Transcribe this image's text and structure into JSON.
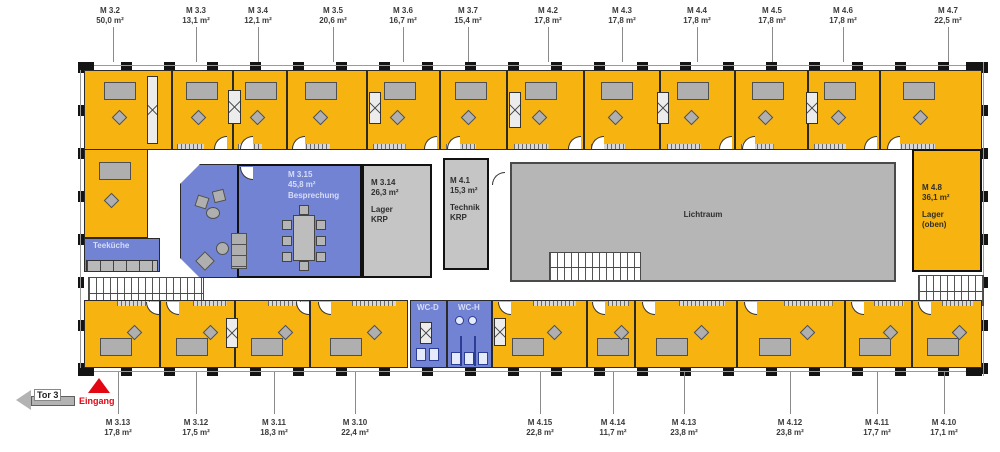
{
  "rooms": {
    "m3_2": {
      "label": "M 3.2",
      "area": "50,0 m²"
    },
    "m3_3": {
      "label": "M 3.3",
      "area": "13,1 m²"
    },
    "m3_4": {
      "label": "M 3.4",
      "area": "12,1 m²"
    },
    "m3_5": {
      "label": "M 3.5",
      "area": "20,6 m²"
    },
    "m3_6": {
      "label": "M 3.6",
      "area": "16,7 m²"
    },
    "m3_7": {
      "label": "M 3.7",
      "area": "15,4 m²"
    },
    "m4_2": {
      "label": "M 4.2",
      "area": "17,8 m²"
    },
    "m4_3": {
      "label": "M 4.3",
      "area": "17,8 m²"
    },
    "m4_4": {
      "label": "M 4.4",
      "area": "17,8 m²"
    },
    "m4_5": {
      "label": "M 4.5",
      "area": "17,8 m²"
    },
    "m4_6": {
      "label": "M 4.6",
      "area": "17,8 m²"
    },
    "m4_7": {
      "label": "M 4.7",
      "area": "22,5 m²"
    },
    "m3_13": {
      "label": "M 3.13",
      "area": "17,8 m²"
    },
    "m3_12": {
      "label": "M 3.12",
      "area": "17,5 m²"
    },
    "m3_11": {
      "label": "M 3.11",
      "area": "18,3 m²"
    },
    "m3_10": {
      "label": "M 3.10",
      "area": "22,4 m²"
    },
    "m4_15": {
      "label": "M 4.15",
      "area": "22,8 m²"
    },
    "m4_14": {
      "label": "M 4.14",
      "area": "11,7 m²"
    },
    "m4_13": {
      "label": "M 4.13",
      "area": "23,8 m²"
    },
    "m4_12": {
      "label": "M 4.12",
      "area": "23,8 m²"
    },
    "m4_11": {
      "label": "M 4.11",
      "area": "17,7 m²"
    },
    "m4_10": {
      "label": "M 4.10",
      "area": "17,1 m²"
    },
    "m3_15": {
      "label": "M 3.15",
      "area": "45,8 m²",
      "use": "Besprechung"
    },
    "m3_14": {
      "label": "M 3.14",
      "area": "26,3 m²",
      "use": "Lager",
      "org": "KRP"
    },
    "m4_1": {
      "label": "M 4.1",
      "area": "15,3 m²",
      "use": "Technik",
      "org": "KRP"
    },
    "m4_8": {
      "label": "M 4.8",
      "area": "36,1 m²",
      "use": "Lager",
      "note": "(oben)"
    },
    "lichtraum": {
      "label": "Lichtraum"
    },
    "teekueche": {
      "label": "Teeküche"
    },
    "wc_d": {
      "label": "WC-D"
    },
    "wc_h": {
      "label": "WC-H"
    }
  },
  "annotations": {
    "entrance": "Eingang",
    "gate": "Tor 3"
  },
  "colors": {
    "office": "#F7B410",
    "meeting": "#7383D4",
    "utility": "#C5C5C5",
    "lichtraum": "#B6B6B6",
    "entrance_red": "#E30613"
  }
}
